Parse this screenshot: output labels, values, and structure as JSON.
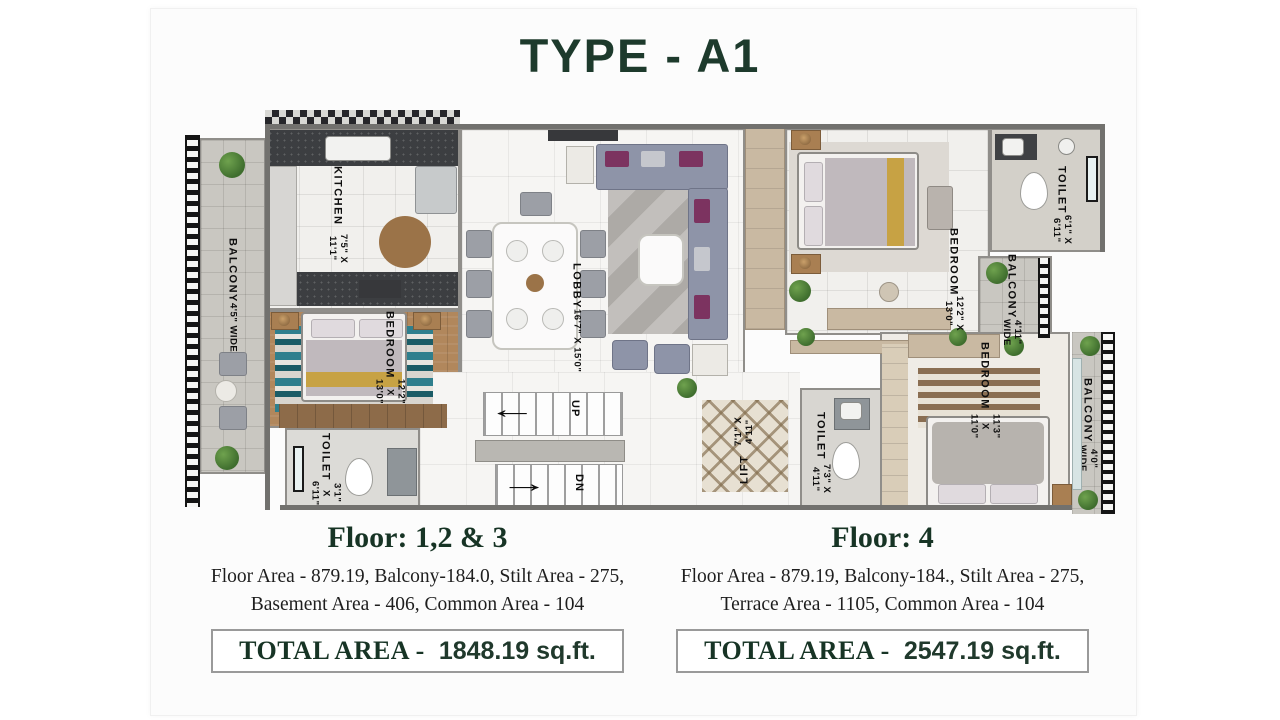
{
  "title": "TYPE - A1",
  "colors": {
    "accent_green": "#1d3a2c",
    "body_text": "#1e1e1e",
    "plan_label": "#0e0e0e"
  },
  "plan": {
    "balcony_left": {
      "name": "BALCONY",
      "dims": "4'5\" WIDE"
    },
    "kitchen": {
      "name": "KITCHEN",
      "dims": "7'5\" X 11'1\""
    },
    "bedroom_left": {
      "name": "BEDROOM",
      "dims": "12'2\" X 13'0\""
    },
    "toilet_left": {
      "name": "TOILET",
      "dims": "3'1\" X 6'11\""
    },
    "lobby": {
      "name": "LOBBY",
      "dims": "16'7\" X 15'0\""
    },
    "stairs": {
      "up": "UP",
      "dn": "DN",
      "up_arrow": "←",
      "dn_arrow": "→"
    },
    "lift": {
      "name": "LIFT",
      "dims": "7'1\" X 4'11\""
    },
    "toilet_mid": {
      "name": "TOILET",
      "dims": "7'3\" X 4'11\""
    },
    "bedroom_top_right": {
      "name": "BEDROOM",
      "dims": "12'2\" X 13'0\""
    },
    "toilet_top_right": {
      "name": "TOILET",
      "dims": "6'1\" X 6'11\""
    },
    "balcony_right_top": {
      "name": "BALCONY",
      "dims": "4'11\" WIDE"
    },
    "bedroom_bottom_right": {
      "name": "BEDROOM",
      "dims": "11'3\" X 11'0\""
    },
    "balcony_right_bottom": {
      "name": "BALCONY",
      "dims": "4'0\" WIDE"
    }
  },
  "floors": [
    {
      "heading": "Floor: 1,2 & 3",
      "line1": "Floor Area - 879.19, Balcony-184.0, Stilt Area - 275,",
      "line2": "Basement Area - 406, Common Area - 104",
      "total_label": "TOTAL AREA -",
      "total_value": "1848.19 sq.ft."
    },
    {
      "heading": "Floor: 4",
      "line1": "Floor Area - 879.19, Balcony-184., Stilt Area - 275,",
      "line2": "Terrace Area - 1105, Common Area - 104",
      "total_label": "TOTAL AREA -",
      "total_value": "2547.19 sq.ft."
    }
  ]
}
